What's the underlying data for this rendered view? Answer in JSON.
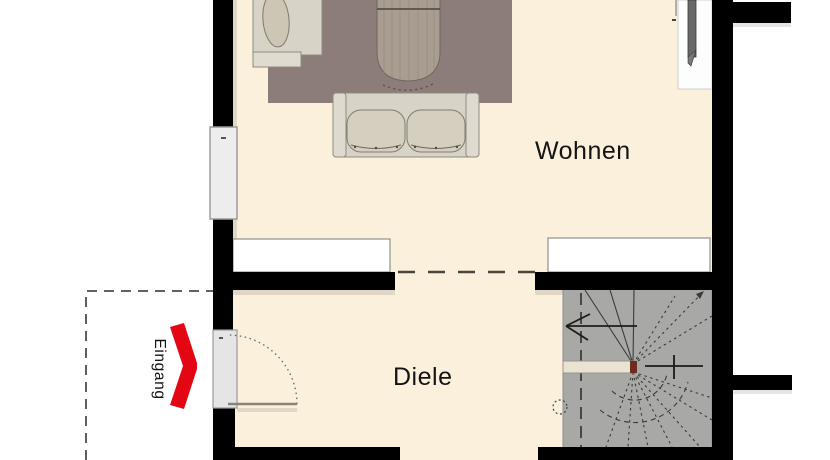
{
  "plan": {
    "labels": {
      "living_room": "Wohnen",
      "hallway": "Diele",
      "entrance": "Eingang"
    },
    "rooms": [
      {
        "name": "Wohnen",
        "type": "living-room"
      },
      {
        "name": "Diele",
        "type": "hallway"
      }
    ],
    "furniture": [
      "rug",
      "chaise-longue",
      "coffee-table",
      "two-seat-sofa",
      "tv-sideboard",
      "sideboard-left",
      "sideboard-right",
      "winder-staircase",
      "entrance-door",
      "window"
    ],
    "annotations": {
      "entrance_arrow": "red chevron pointing right toward entrance door",
      "stair_direction": "arrow pointing left on staircase",
      "open_passage": "dashed line between Wohnen and Diele"
    },
    "colors": {
      "floor": "#faf0dc",
      "wall": "#000000",
      "rug": "#8c7d7a",
      "upholstery": "#d8d3c7",
      "stair": "#a8a8a6",
      "stair_rail": "#eae3d2",
      "window_glass": "#ededed",
      "door": "#e5e5e5",
      "entrance_accent": "#e30613",
      "wood_table": "#a89d90"
    }
  }
}
